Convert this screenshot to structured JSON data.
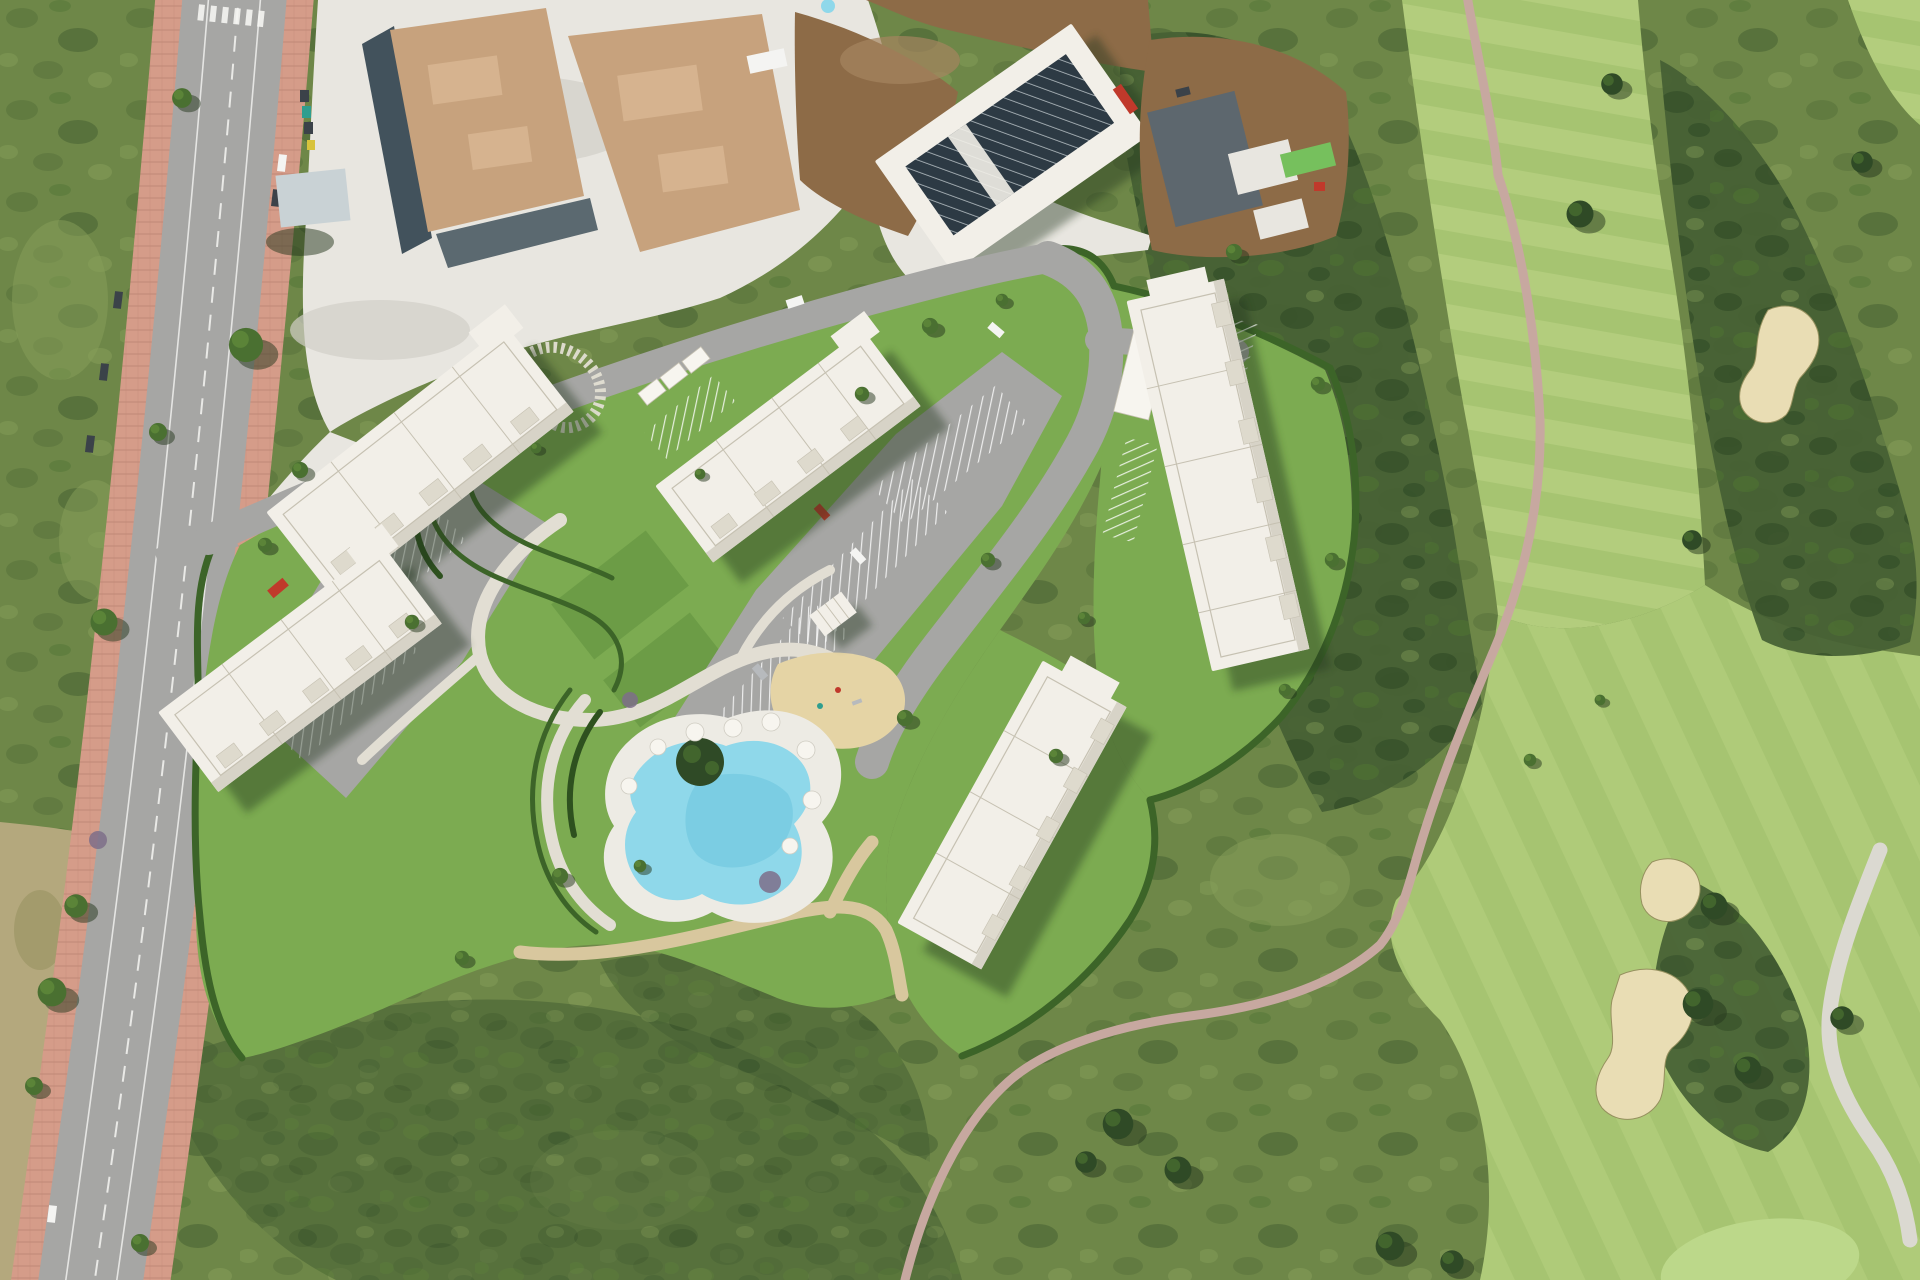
{
  "scene": {
    "title": "Aerial view — rendered residential development beside a golf course",
    "view": "top-down satellite photo with 3D site-plan render overlay",
    "no_visible_text": true
  },
  "palette": {
    "scrub_base": "#6e8748",
    "scrub_light": "#87a059",
    "scrub_dark": "#55703a",
    "rough_dark": "#455f33",
    "tree_dark": "#2f4a26",
    "tree_mid": "#4a7031",
    "tree_light": "#5f8a3b",
    "shadow_green": "#24361c",
    "dry_grass": "#b4a87d",
    "dry_dark": "#95905e",
    "fairway": "#a6c471",
    "fairway_light": "#b6d07f",
    "putting_green": "#bcd88a",
    "sand_bunker": "#e9ddb4",
    "cart_path": "#c7a8a0",
    "road_white": "#dbd9d1",
    "asphalt": "#a6a6a4",
    "lane_white": "#f5f5f2",
    "sidewalk_pink": "#d59c89",
    "brick_line": "#c08876",
    "gravel": "#e8e6e0",
    "gravel_shade": "#d2cfc7",
    "slab_tan": "#c7a27d",
    "slab_light": "#dab893",
    "formwork": "#42525c",
    "dirt": "#8d6b47",
    "dirt_light": "#a5855f",
    "solar_roof": "#2d3a44",
    "solar_stripe": "#cfd6da",
    "roof_grey": "#5d676e",
    "shed_roof": "#c9d2d5",
    "container_green": "#76c05d",
    "bin_yellow": "#d8c33c",
    "bin_teal": "#2f9e8f",
    "lawn": "#7cab51",
    "lawn_dark": "#5f8f3e",
    "hedge": "#3c6428",
    "hedge_dark": "#2e511f",
    "garden_path": "#e2ded3",
    "sand_play": "#e5d4a5",
    "sand_path": "#d8c79e",
    "pool_deck": "#edebe4",
    "pool_water": "#8fd8ea",
    "pool_deep": "#6ec6dd",
    "umbrella_white": "#f7f5ef",
    "building_roof": "#f2efe8",
    "building_side": "#d7d3c7",
    "roof_line": "#c6c1b2",
    "roof_terrace": "#dedacd",
    "car_red": "#c0392b",
    "car_white": "#f4f4f2",
    "car_silver": "#b7babd",
    "car_dark": "#3b4249"
  },
  "features": {
    "development": {
      "apartment_buildings": 5,
      "building_ids": [
        "northwest",
        "southwest",
        "north",
        "northeast",
        "southeast"
      ],
      "swimming_pool": 1,
      "pool_shape": "kidney",
      "pool_island_planter": 1,
      "parasols": 8,
      "playground_sand_area": 1,
      "spiral_slat_path": 1,
      "terraced_hedge_garden": true,
      "pool_pavilion": 1,
      "parking_lots": 3,
      "carport_pergola_rows": true,
      "perimeter_hedge": true
    },
    "golf_course": {
      "fairways": 3,
      "sand_bunkers": 3,
      "cart_path": true,
      "service_road": true,
      "putting_green": 1,
      "tree_clusters": true
    },
    "roads": {
      "main_road_lanes": 2,
      "sidewalks": "terracotta brick both sides",
      "crosswalk": 1,
      "site_access_road": true
    },
    "construction_zone": {
      "foundation_slabs": 2,
      "building_with_solar_roof": 1,
      "staging_yard": 1,
      "storage_container_green": 1,
      "shed": 1,
      "white_gravel_lot": true,
      "earthworks_dirt": true
    },
    "vehicles": {
      "approx_visible_cars": 15,
      "car_colors": [
        "red",
        "white",
        "silver",
        "dark"
      ]
    },
    "vegetation": {
      "scrubland": true,
      "dry_grass_strip": true,
      "street_trees": true
    }
  }
}
